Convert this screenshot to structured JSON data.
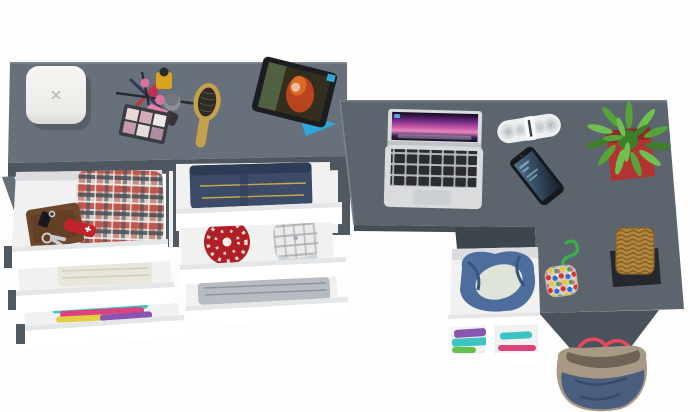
{
  "scene": {
    "description": "Top-down 3D product render of a grey furniture set: a dresser with six open white drawers full of clothes and accessories, joined to an L-shaped desk with laptop, tablet, speaker, phone, plant, basket and bags",
    "furniture": [
      {
        "name": "dresser",
        "drawers": [
          {
            "contents": "leather wallet, car key, pocket knife, key ring, plaid shirt"
          },
          {
            "contents": "folded towel"
          },
          {
            "contents": "colorful folded clothes"
          },
          {
            "contents": "folded jeans"
          },
          {
            "contents": "red knit beanie, plaid flat cap"
          },
          {
            "contents": "folded grey shirt"
          }
        ]
      },
      {
        "name": "l-shaped-desk",
        "features": [
          "open under-desk drawer with denim jacket",
          "open shelf with folded clothes"
        ]
      }
    ],
    "items_on_top": [
      "white jewelry box",
      "makeup set with eyeshadow palette, pencils, nail polish, lipstick",
      "wooden hairbrush",
      "tablet on blue stand",
      "open laptop",
      "white bluetooth speaker",
      "smartphone",
      "green plant in red pot",
      "pompom keychain with green rope",
      "wicker basket on black mat",
      "denim tote bag with red handles"
    ]
  },
  "colors": {
    "bg": "#fdfdfd",
    "dresser_top": "#68717b",
    "dresser_front": "#4e565f",
    "leg": "#667078",
    "side_white": "#eef0f2",
    "slide_dark": "#505860",
    "drawer_front": "#ffffff",
    "drawer_bevel": "#e4e6e8",
    "drawer_edge": "#cfd2d5",
    "drawer_interior": "#f1f1f2",
    "interior_shadow": "#dadcdf",
    "desk_top": "#5c646e",
    "desk_edge": "#7b838c",
    "desk_panel": "#4a525b",
    "unit_top": "#3e454d",
    "desk_under_shadow": "#454d56",
    "wallet": "#6e482a",
    "wallet_dark": "#55351e",
    "key_silver": "#c6cbd0",
    "knife_red": "#c2222b",
    "knife_white": "#ffffff",
    "plaid_base": "#d9d2c7",
    "plaid_red": "#bf5048",
    "plaid_dark": "#4a4e56",
    "plaid_white": "#f2efe8",
    "towel": "#e9e6da",
    "towel_line": "#d3cfbe",
    "clothes_teal": "#3cc4c0",
    "clothes_magenta": "#df417d",
    "clothes_yellow": "#e2ce3f",
    "clothes_purple": "#8a55b0",
    "clothes_green": "#65c14d",
    "jeans": "#3b4b68",
    "jeans_dark": "#2d3b55",
    "jeans_stitch": "#c8a74b",
    "beanie_red": "#b01f26",
    "beanie_white": "#f6efe8",
    "cap_base": "#ebebeb",
    "cap_line": "#a6abb1",
    "cap_brim": "#ced3d7",
    "shirt_gray": "#b7bcc2",
    "shirt_line": "#8f959c",
    "denim_jacket": "#4d6d9d",
    "denim_fold": "#3a547e",
    "lining": "#dfe4d8",
    "laptop_body": "#d9dbdd",
    "laptop_hinge": "#c1c4c7",
    "key_bg": "#b4b7ba",
    "key_black": "#2b2d31",
    "trackpad": "#cdd0d2",
    "screen_logo": "#58a7e0",
    "speaker_body": "#edeff1",
    "speaker_ring": "#dcdfe2",
    "speaker_ring_inner": "#c9cdd1",
    "speaker_dot": "#b2b7bc",
    "speaker_clasp": "#f8f9fa",
    "speaker_slit": "#3a3e43",
    "phone_body": "#17191c",
    "pot_red": "#b13430",
    "pot_rim": "#8d2a27",
    "leaf_a": "#56a23b",
    "leaf_b": "#70c050",
    "leaf_c": "#3e7e2b",
    "rope_green": "#37b449",
    "pom_bg": "#d6d0c6",
    "pom_dots": [
      "#d8322e",
      "#2e6ad8",
      "#e8c832",
      "#3fa844",
      "#e060a0",
      "#f2efe8"
    ],
    "basket_tan": "#b4873f",
    "basket_line": "#876025",
    "mat_black": "#25282c",
    "bag_khaki": "#a79983",
    "bag_denim": "#4a5e80",
    "bag_fold": "#39496a",
    "bag_inner": "#6e6355",
    "bag_handle": "#e8465d",
    "tablet_body": "#1b1d20",
    "tablet_stand": "#2ea7db",
    "hair_a": "#b8431c",
    "hair_b": "#dd6a22",
    "face": "#e8c29e",
    "tab_bg": "#332e1e",
    "tab_bg2": "#57684a",
    "box_mark": "#bdbdb9",
    "brush_tan": "#c6a14c",
    "brush_dark": "#2e2a25",
    "pencil_red": "#c23434",
    "pencil_dark": "#26292f",
    "pencil_blue": "#303a55",
    "bottle_pink": "#e070a0",
    "bottle_red": "#c03050",
    "bottle_yellow": "#d9a31f",
    "bottle_cap": "#2a2a2e",
    "jar_gray": "#8c9096",
    "jar_cap": "#6e7278",
    "lipstick_pink": "#e87fa8",
    "lipstick_cap": "#3a3038",
    "palette_frame": "#3a3d43",
    "palette_pans": [
      "#e8d9d8",
      "#d2aab8",
      "#f0e8e4",
      "#c49aac",
      "#e6ded8",
      "#b08ca0"
    ]
  }
}
